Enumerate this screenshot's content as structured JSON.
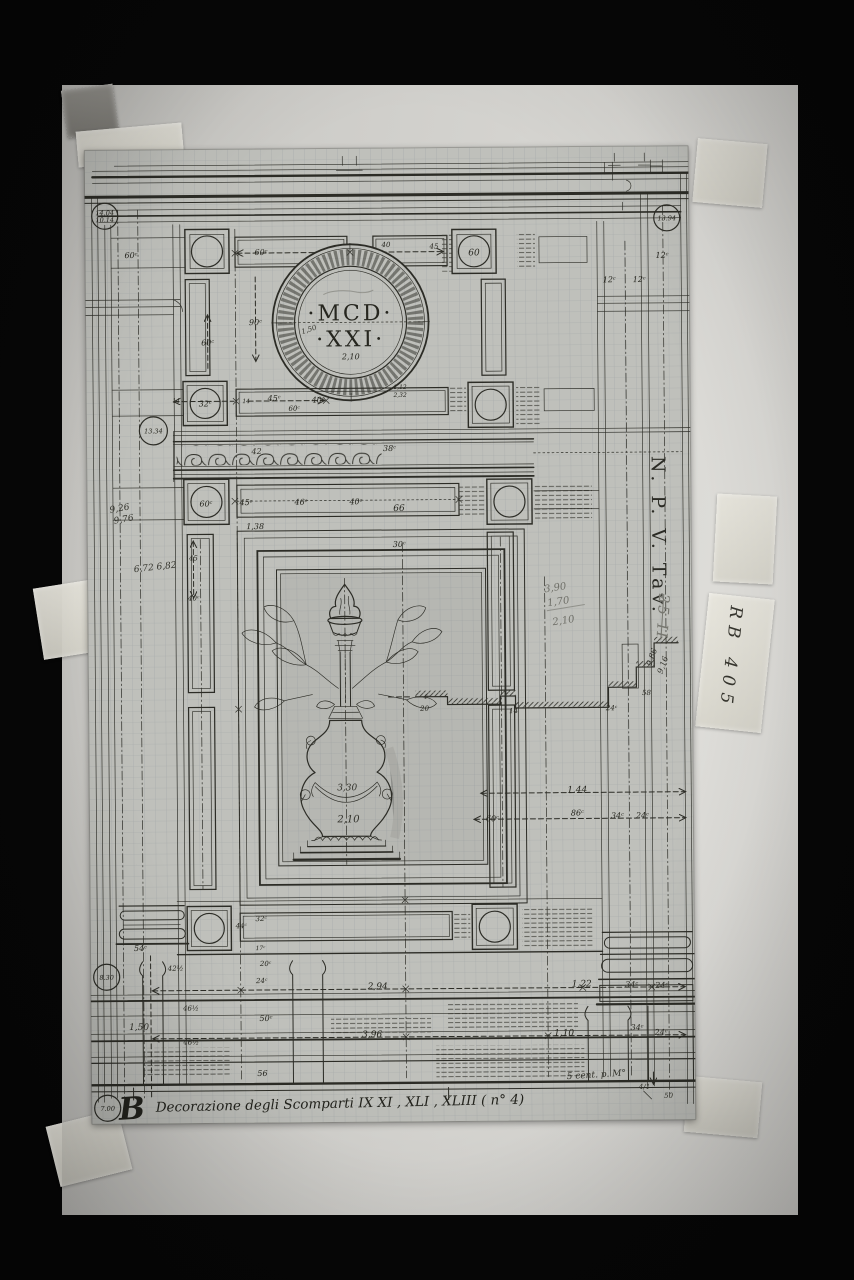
{
  "photo": {
    "background_color": "#060606",
    "board_color": "#d3d2ce",
    "sheet_color": "#bfc0bb",
    "ink_color": "#26261f",
    "pencil_color": "#6f6f68"
  },
  "medallion": {
    "line1": "·MCD·",
    "line2": "·XXI·"
  },
  "labels": {
    "side_label": "N. P. V. Tav.",
    "side_label_number": "25 II",
    "tape_label": "RB 405",
    "caption_initial": "B",
    "caption": "Decorazione degli Scomparti IX XI , XLI , XLIII ( n° 4)"
  },
  "circled_refs": [
    {
      "lines": [
        "14.04",
        "10.14"
      ],
      "x": 20,
      "y": 66,
      "rad": 13
    },
    {
      "lines": [
        "13.94"
      ],
      "x": 582,
      "y": 72,
      "rad": 13
    },
    {
      "lines": [
        "13.34"
      ],
      "x": 67,
      "y": 281,
      "rad": 14
    },
    {
      "lines": [
        "8.30"
      ],
      "x": 16,
      "y": 827,
      "rad": 13
    },
    {
      "lines": [
        "7.00"
      ],
      "x": 16,
      "y": 958,
      "rad": 13
    }
  ],
  "annotations": [
    {
      "t": "12ᶜ",
      "x": 577,
      "y": 112
    },
    {
      "t": "12ᶜ",
      "x": 524,
      "y": 136
    },
    {
      "t": "12ᶜ",
      "x": 554,
      "y": 136
    },
    {
      "t": "60ᶜ",
      "x": 46,
      "y": 108
    },
    {
      "t": "60ᶜ",
      "x": 176,
      "y": 106
    },
    {
      "t": "40",
      "x": 301,
      "y": 99,
      "s": 7
    },
    {
      "t": "45",
      "x": 349,
      "y": 101,
      "s": 7
    },
    {
      "t": "60",
      "x": 389,
      "y": 108,
      "s": 9
    },
    {
      "t": "90ᶜ",
      "x": 170,
      "y": 176
    },
    {
      "t": "60ᶜ",
      "x": 122,
      "y": 196
    },
    {
      "t": "1,50",
      "x": 224,
      "y": 183,
      "r": -18,
      "s": 7,
      "c": "hand"
    },
    {
      "t": "2,10",
      "x": 265,
      "y": 211,
      "s": 8
    },
    {
      "t": "1,12",
      "x": 314,
      "y": 241,
      "s": 6
    },
    {
      "t": "2,32",
      "x": 314,
      "y": 249,
      "s": 6
    },
    {
      "t": "14",
      "x": 90,
      "y": 253,
      "s": 6
    },
    {
      "t": "32ᶜ",
      "x": 119,
      "y": 257,
      "s": 8
    },
    {
      "t": "14",
      "x": 160,
      "y": 254,
      "s": 6
    },
    {
      "t": "45ᶜ",
      "x": 188,
      "y": 252
    },
    {
      "t": "60ᶜ",
      "x": 208,
      "y": 262,
      "s": 7
    },
    {
      "t": "40ᶜ",
      "x": 232,
      "y": 254
    },
    {
      "t": "42",
      "x": 170,
      "y": 305,
      "s": 8,
      "c": "hand"
    },
    {
      "t": "38ᶜ",
      "x": 303,
      "y": 303
    },
    {
      "t": "60ᶜ",
      "x": 119,
      "y": 357
    },
    {
      "t": "45ᶜ",
      "x": 159,
      "y": 356
    },
    {
      "t": "46ᶜ",
      "x": 214,
      "y": 356
    },
    {
      "t": "40ᶜ",
      "x": 269,
      "y": 356
    },
    {
      "t": "66",
      "x": 312,
      "y": 363,
      "s": 9
    },
    {
      "t": "1,38",
      "x": 168,
      "y": 380,
      "s": 8
    },
    {
      "t": "30ᶜ",
      "x": 312,
      "y": 399
    },
    {
      "t": "9,26",
      "x": 33,
      "y": 361,
      "r": -10,
      "s": 9,
      "c": "hand"
    },
    {
      "t": "9,76",
      "x": 37,
      "y": 372,
      "r": -10,
      "s": 9,
      "c": "hand"
    },
    {
      "t": "6,72 6,82",
      "x": 68,
      "y": 420,
      "r": -6,
      "s": 9,
      "c": "hand"
    },
    {
      "t": "45",
      "x": 106,
      "y": 411,
      "s": 7
    },
    {
      "t": "40ᶜ",
      "x": 106,
      "y": 451,
      "s": 7
    },
    {
      "t": "3,90",
      "x": 468,
      "y": 444,
      "r": -8,
      "s": 10,
      "c": "pencil"
    },
    {
      "t": "1,70",
      "x": 471,
      "y": 458,
      "r": -8,
      "s": 10,
      "c": "pencil"
    },
    {
      "t": "2,10",
      "x": 476,
      "y": 477,
      "r": -8,
      "s": 10,
      "c": "pencil"
    },
    {
      "t": "9,86",
      "x": 566,
      "y": 512,
      "r": -70,
      "s": 8,
      "c": "hand"
    },
    {
      "t": "9,16",
      "x": 577,
      "y": 520,
      "r": -70,
      "s": 8,
      "c": "hand"
    },
    {
      "t": "4ᶜ",
      "x": 338,
      "y": 551,
      "s": 6
    },
    {
      "t": "20",
      "x": 336,
      "y": 563,
      "s": 7
    },
    {
      "t": "14",
      "x": 425,
      "y": 566,
      "s": 7
    },
    {
      "t": "24ᶜ",
      "x": 523,
      "y": 564,
      "s": 7
    },
    {
      "t": "58",
      "x": 558,
      "y": 549,
      "s": 7
    },
    {
      "t": "3,30",
      "x": 258,
      "y": 642,
      "s": 9,
      "c": "hand"
    },
    {
      "t": "2,10",
      "x": 259,
      "y": 674,
      "s": 10,
      "c": "hand"
    },
    {
      "t": "1.44",
      "x": 488,
      "y": 646,
      "s": 9
    },
    {
      "t": "60ᶜ",
      "x": 403,
      "y": 674
    },
    {
      "t": "86ᶜ",
      "x": 488,
      "y": 669
    },
    {
      "t": "34ᶜ",
      "x": 528,
      "y": 672
    },
    {
      "t": "24ᶜ",
      "x": 553,
      "y": 672
    },
    {
      "t": "32ᶜ",
      "x": 171,
      "y": 772,
      "s": 7
    },
    {
      "t": "44ᶜ",
      "x": 151,
      "y": 779,
      "s": 7
    },
    {
      "t": "17ᶜ",
      "x": 170,
      "y": 801,
      "s": 6
    },
    {
      "t": "54ᶜ",
      "x": 50,
      "y": 801
    },
    {
      "t": "42½",
      "x": 85,
      "y": 821,
      "s": 7
    },
    {
      "t": "20ᶜ",
      "x": 175,
      "y": 817,
      "s": 7
    },
    {
      "t": "24ᶜ",
      "x": 171,
      "y": 834,
      "s": 7
    },
    {
      "t": "50ᶜ",
      "x": 175,
      "y": 872
    },
    {
      "t": "56",
      "x": 171,
      "y": 927,
      "s": 8
    },
    {
      "t": "1,50",
      "x": 48,
      "y": 880,
      "s": 9,
      "c": "hand"
    },
    {
      "t": "46½",
      "x": 100,
      "y": 861,
      "s": 7
    },
    {
      "t": "46½",
      "x": 100,
      "y": 895,
      "s": 7
    },
    {
      "t": "2,94",
      "x": 287,
      "y": 841,
      "s": 9
    },
    {
      "t": "1,22",
      "x": 491,
      "y": 840,
      "s": 9
    },
    {
      "t": "34ᶜ",
      "x": 541,
      "y": 841
    },
    {
      "t": "24ᶜ",
      "x": 571,
      "y": 842
    },
    {
      "t": "3,96",
      "x": 281,
      "y": 889,
      "s": 9
    },
    {
      "t": "1,10",
      "x": 473,
      "y": 889,
      "s": 9
    },
    {
      "t": "34ᶜ",
      "x": 546,
      "y": 884
    },
    {
      "t": "24ᶜ",
      "x": 570,
      "y": 889
    },
    {
      "t": "5 cent. p. M°",
      "x": 505,
      "y": 931,
      "r": -3,
      "s": 9,
      "c": "hand"
    },
    {
      "t": "4/1",
      "x": 553,
      "y": 943,
      "s": 7,
      "c": "hand"
    },
    {
      "t": "50",
      "x": 577,
      "y": 952,
      "s": 7,
      "c": "hand"
    }
  ]
}
